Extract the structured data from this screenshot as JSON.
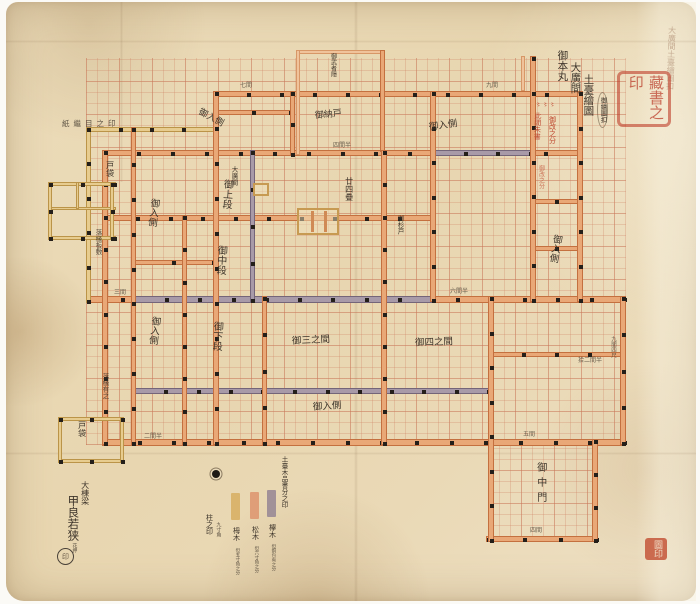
{
  "title": {
    "lines": [
      "御本丸",
      "大廣間",
      "土臺繪圖"
    ],
    "note": "御繪圖扣"
  },
  "archive_note": "大廣間土臺繪圖扣",
  "joint_mark": "紙繼目之印",
  "seals": {
    "library": "藏書之印",
    "corner": "圖印",
    "signature": "印"
  },
  "signature": {
    "rank": "大棟梁",
    "name": "甲良若狭",
    "kao": "花押"
  },
  "rooms": {
    "jodan_prefix": "大廣間",
    "jodan": "御上段",
    "chudan": "御中段",
    "gedan": "御下段",
    "irikawa": "御入側",
    "nando": "御納戸",
    "mushakakushi": "御武者隠",
    "sannoma": "御三之間",
    "yonnoma": "御四之間",
    "chumon": "御中門",
    "tobukuro": "戸袋",
    "ochien_itajiki": "落椽板敷",
    "ochien": "落椽有之",
    "sugido": "御杉戸",
    "tatami24": "廿四疊"
  },
  "red_notes": [
    "此間朱書",
    "御改之分",
    "〻〻〻"
  ],
  "legend": {
    "header": "土臺木品書分之印",
    "pillar": {
      "label": "柱之印",
      "note": "九寸角"
    },
    "items": [
      {
        "color": "#d9b268",
        "label": "栂木",
        "note": "但五寸角之分"
      },
      {
        "color": "#df9a74",
        "label": "松木",
        "note": "但六寸角之分"
      },
      {
        "color": "#9c8c96",
        "label": "欅木",
        "note": "但銅包有之分"
      }
    ]
  },
  "dims": [
    "七間",
    "九間",
    "四間半",
    "三間",
    "六間半",
    "拾二間半",
    "九間四尺",
    "五間",
    "二間半",
    "四間"
  ],
  "colors": {
    "beam_orange": "#e9a877",
    "beam_yellow": "#e7cc8f",
    "beam_gray": "#a89aa8",
    "ink": "#3d342a",
    "seal_red": "#bf4830",
    "paper": "#ead9b6"
  }
}
